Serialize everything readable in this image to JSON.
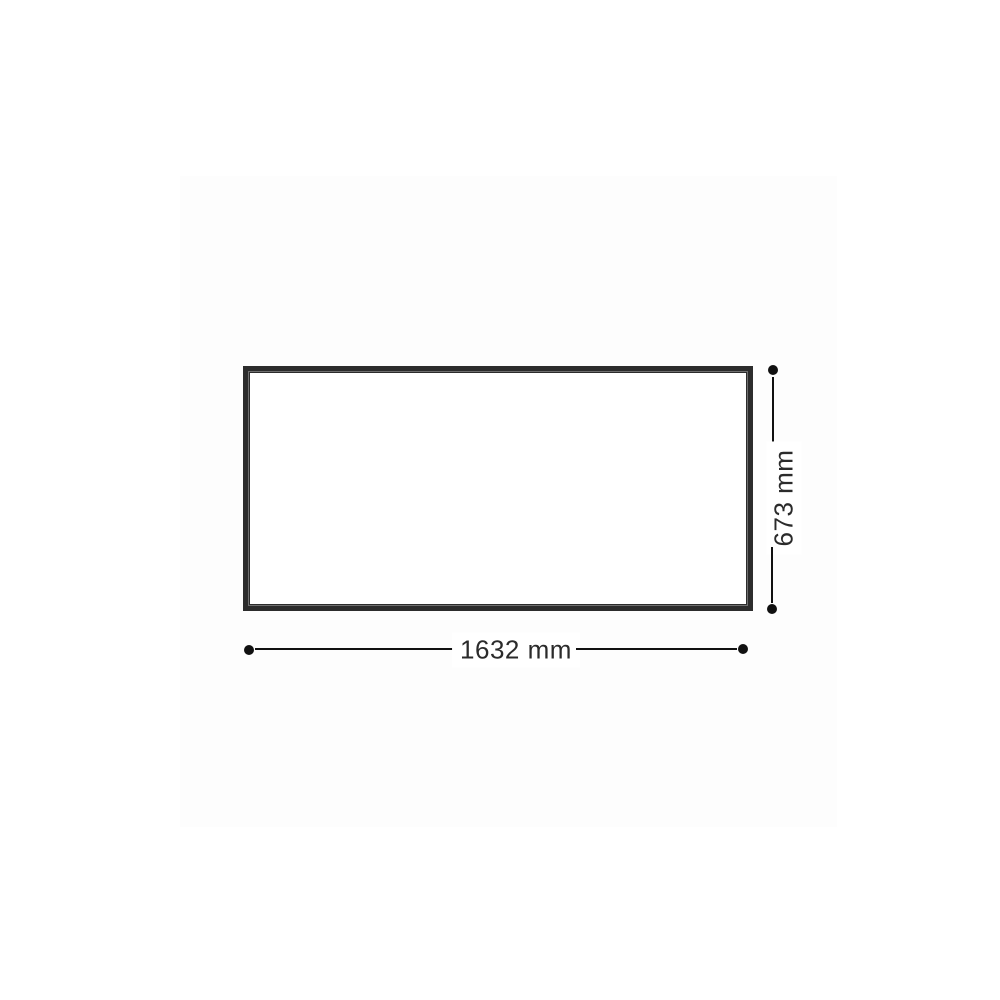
{
  "diagram": {
    "type": "product-dimension-drawing",
    "shape": "rectangular-panel-frame",
    "dimensions": {
      "width": {
        "label": "1632 mm",
        "value": 1632,
        "unit": "mm",
        "orientation": "horizontal",
        "placement": "bottom"
      },
      "height": {
        "label": "673 mm",
        "value": 673,
        "unit": "mm",
        "orientation": "vertical",
        "placement": "right"
      }
    },
    "endpoint_marker": "filled-circle"
  },
  "theme": {
    "background": "#ffffff",
    "canvas_tint": "#fdfdfd",
    "frame_color": "#2c2c2c",
    "frame_highlight": "#6f6f6f",
    "line_color": "#111111",
    "text_color": "#2b2b2b"
  }
}
